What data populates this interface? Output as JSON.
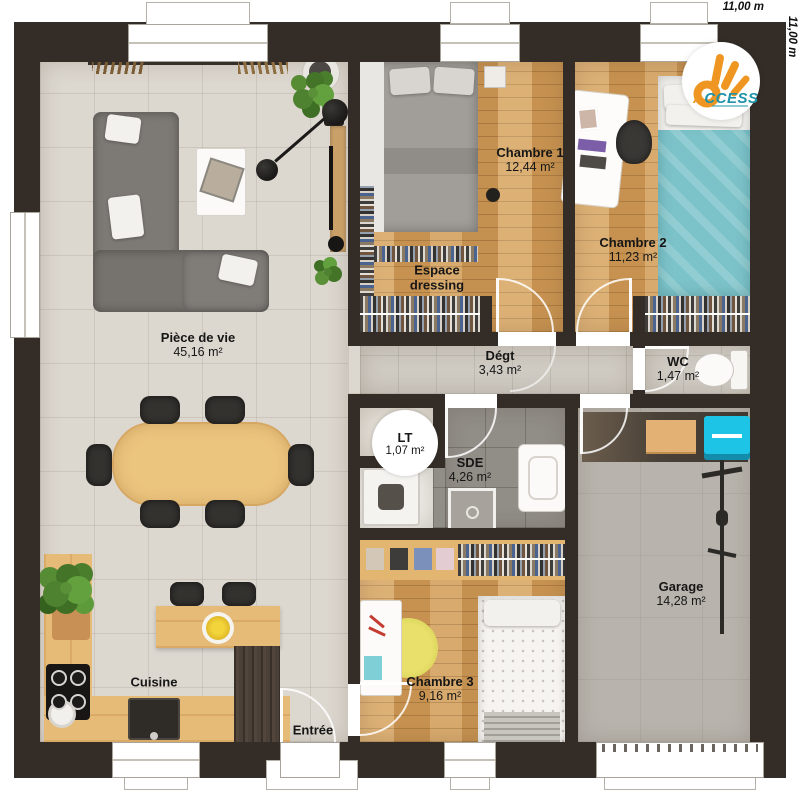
{
  "meta": {
    "width_label": "11,00 m",
    "height_label": "11,00 m"
  },
  "logo": {
    "text": "ACCESS",
    "first_letter": "A",
    "rest": "CCESS"
  },
  "rooms": {
    "piece_de_vie": {
      "name": "Pièce de vie",
      "area": "45,16 m²"
    },
    "chambre1": {
      "name": "Chambre 1",
      "area": "12,44 m²"
    },
    "chambre2": {
      "name": "Chambre 2",
      "area": "11,23 m²"
    },
    "dressing": {
      "name": "Espace dressing"
    },
    "degt": {
      "name": "Dégt",
      "area": "3,43 m²"
    },
    "wc": {
      "name": "WC",
      "area": "1,47 m²"
    },
    "lt": {
      "name": "LT",
      "area": "1,07 m²"
    },
    "sde": {
      "name": "SDE",
      "area": "4,26 m²"
    },
    "chambre3": {
      "name": "Chambre 3",
      "area": "9,16 m²"
    },
    "garage": {
      "name": "Garage",
      "area": "14,28 m²"
    },
    "cuisine": {
      "name": "Cuisine"
    },
    "entree": {
      "name": "Entrée"
    }
  },
  "colors": {
    "wall": "#342d27",
    "wood_floor": "#d39f5c",
    "tile_floor": "#dcd7cf",
    "sde_tile": "#918d87",
    "garage_floor": "#b8b4ad",
    "teal_bed": "#7cc3c9",
    "tool_chest_cyan": "#1ec4e6",
    "rug_yellow": "#e0da58",
    "logo_orange": "#ef9622",
    "logo_teal": "#1d93aa"
  }
}
